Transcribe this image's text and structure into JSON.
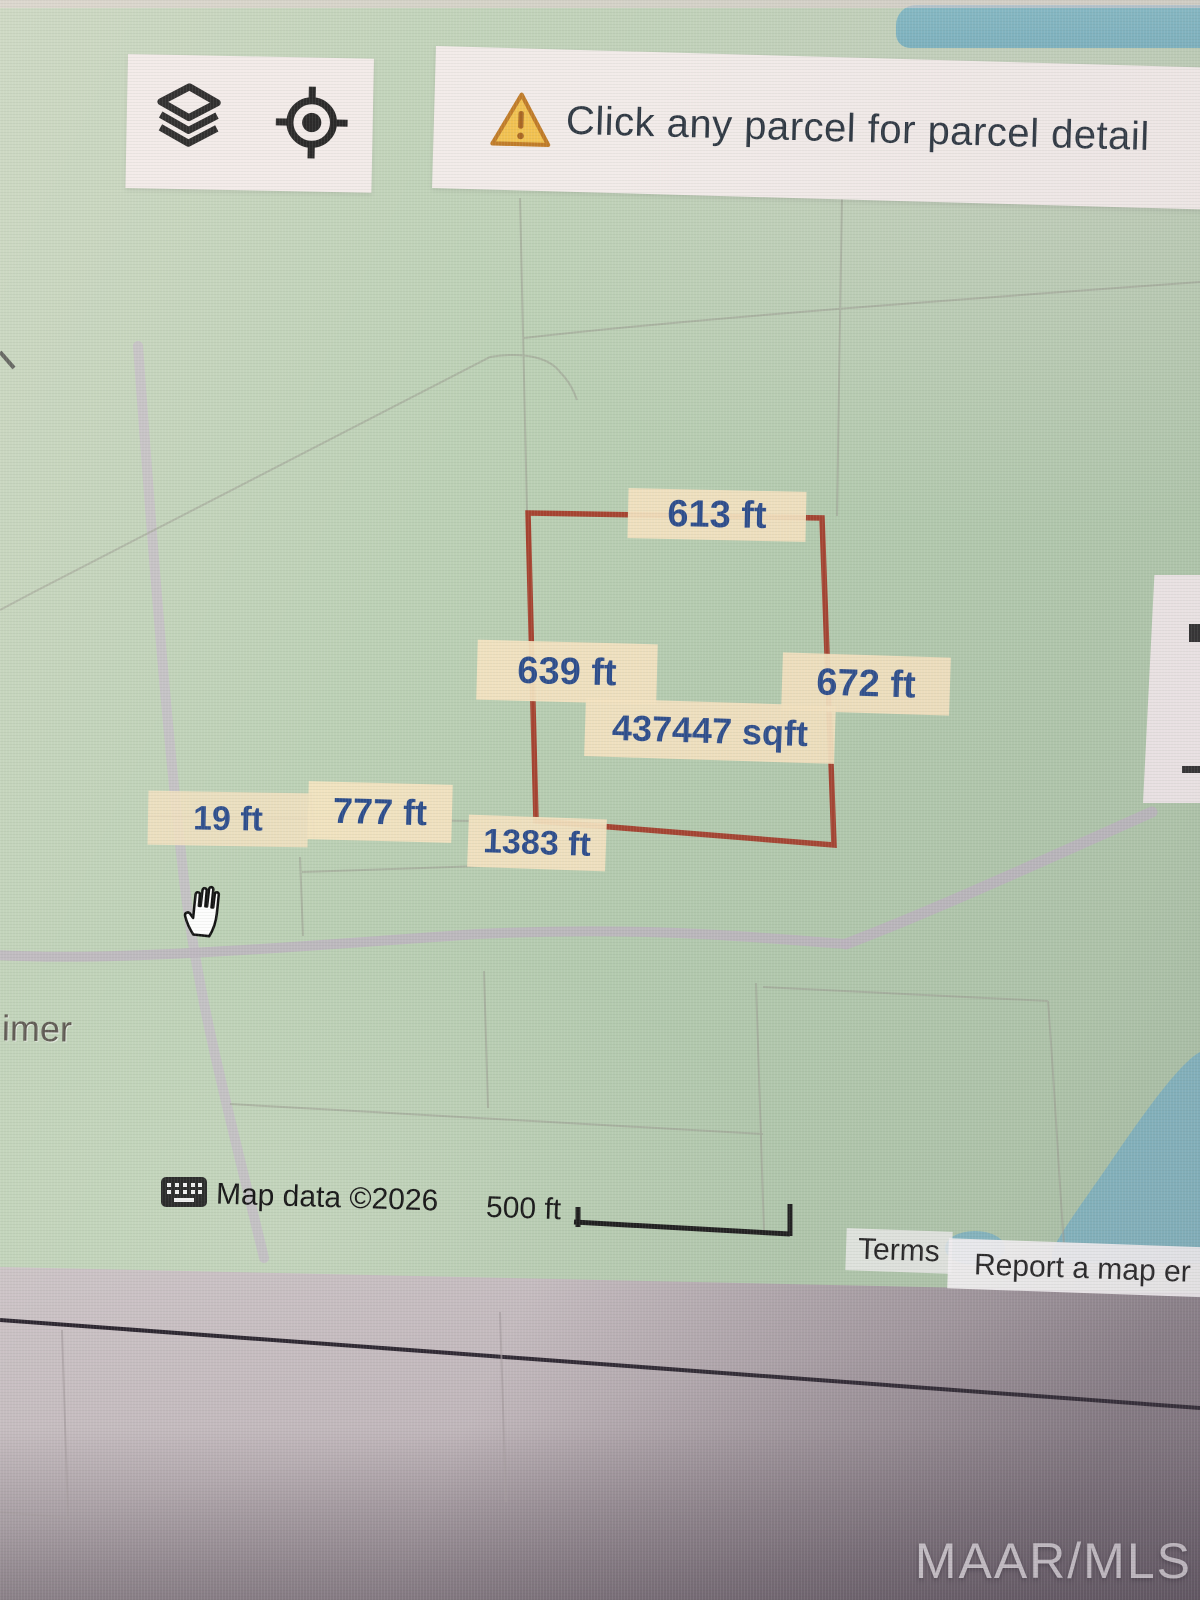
{
  "banner": {
    "icon": "warning-triangle-icon",
    "text": "Click any parcel for parcel detail"
  },
  "toolbar": {
    "icons": [
      "layers-icon",
      "my-location-icon"
    ]
  },
  "parcel": {
    "outline_color": "#a43a28",
    "measurements": {
      "top": "613 ft",
      "left": "639 ft",
      "right": "672 ft",
      "area": "437447 sqft",
      "bottom": "1383 ft",
      "segment_777": "777 ft",
      "segment_19": "19 ft"
    }
  },
  "map": {
    "partial_place_label": "imer",
    "cursor": "open-hand"
  },
  "attribution": {
    "map_data": "Map data ©2026",
    "scale_label": "500 ft",
    "terms": "Terms",
    "report_error": "Report a map er"
  },
  "watermark": {
    "text": "MAAR/MLS"
  },
  "colors": {
    "map_green": "#b4ccaf",
    "water_blue": "#7fb5c1",
    "label_background": "#f4e3c0",
    "label_text": "#2c4d8c",
    "road_gray": "#bdb5c0",
    "panel_white": "#f2ebe9"
  }
}
